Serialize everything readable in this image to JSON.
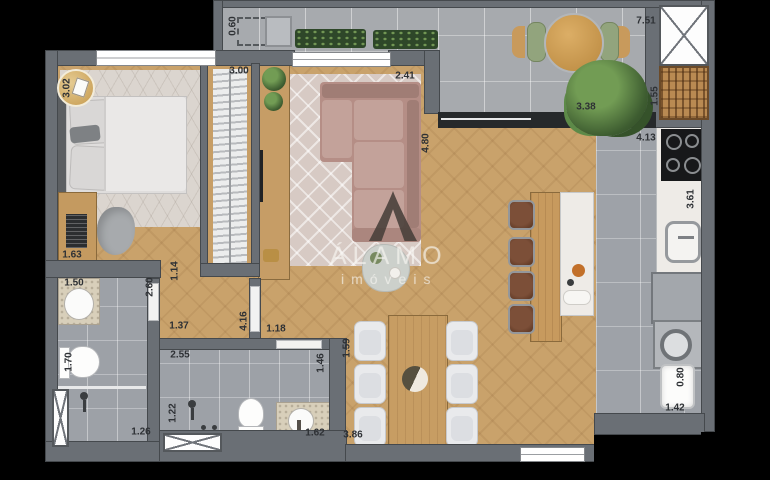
{
  "watermark": {
    "brand": "ÁLAMO",
    "subtitle": "imóveis"
  },
  "badge": {
    "value": "3.02"
  },
  "dimensions": [
    {
      "value": "0.60",
      "x": 233,
      "y": 26,
      "vertical": true
    },
    {
      "value": "7.51",
      "x": 646,
      "y": 21,
      "vertical": false
    },
    {
      "value": "3.00",
      "x": 239,
      "y": 71,
      "vertical": false
    },
    {
      "value": "2.41",
      "x": 405,
      "y": 76,
      "vertical": false
    },
    {
      "value": "3.38",
      "x": 586,
      "y": 107,
      "vertical": false
    },
    {
      "value": "1.55",
      "x": 655,
      "y": 96,
      "vertical": true
    },
    {
      "value": "4.13",
      "x": 646,
      "y": 138,
      "vertical": false
    },
    {
      "value": "4.80",
      "x": 426,
      "y": 143,
      "vertical": true
    },
    {
      "value": "3.61",
      "x": 691,
      "y": 199,
      "vertical": true
    },
    {
      "value": "1.63",
      "x": 72,
      "y": 255,
      "vertical": false
    },
    {
      "value": "1.14",
      "x": 175,
      "y": 271,
      "vertical": true
    },
    {
      "value": "2.60",
      "x": 150,
      "y": 287,
      "vertical": true
    },
    {
      "value": "1.50",
      "x": 74,
      "y": 283,
      "vertical": false
    },
    {
      "value": "1.37",
      "x": 179,
      "y": 326,
      "vertical": false
    },
    {
      "value": "4.16",
      "x": 244,
      "y": 321,
      "vertical": true
    },
    {
      "value": "1.18",
      "x": 276,
      "y": 329,
      "vertical": false
    },
    {
      "value": "1.70",
      "x": 69,
      "y": 362,
      "vertical": true
    },
    {
      "value": "2.55",
      "x": 180,
      "y": 355,
      "vertical": false
    },
    {
      "value": "1.22",
      "x": 173,
      "y": 413,
      "vertical": true
    },
    {
      "value": "1.26",
      "x": 141,
      "y": 432,
      "vertical": false
    },
    {
      "value": "1.46",
      "x": 321,
      "y": 363,
      "vertical": true
    },
    {
      "value": "1.59",
      "x": 347,
      "y": 348,
      "vertical": true
    },
    {
      "value": "1.62",
      "x": 315,
      "y": 433,
      "vertical": false
    },
    {
      "value": "3.86",
      "x": 353,
      "y": 435,
      "vertical": false
    },
    {
      "value": "0.80",
      "x": 681,
      "y": 377,
      "vertical": true
    },
    {
      "value": "1.42",
      "x": 675,
      "y": 408,
      "vertical": false
    }
  ],
  "colors": {
    "background": "#000000",
    "wall": "#6a6f75",
    "wood_floor": "#c9a26b",
    "balcony_tile": "#a7aaae",
    "kitchen_tile": "#9ea2a8",
    "bath_tile": "#9da1a7",
    "bedroom_rug": "#dbd5cf",
    "living_rug": "#d7cac4",
    "sofa": "#b58e86",
    "marble": "#eeebe7",
    "gold_badge": "#c69a4e",
    "watermark_text": "#f8f5f1",
    "logo": "#473f39",
    "plant_green": "#3d5c30"
  }
}
